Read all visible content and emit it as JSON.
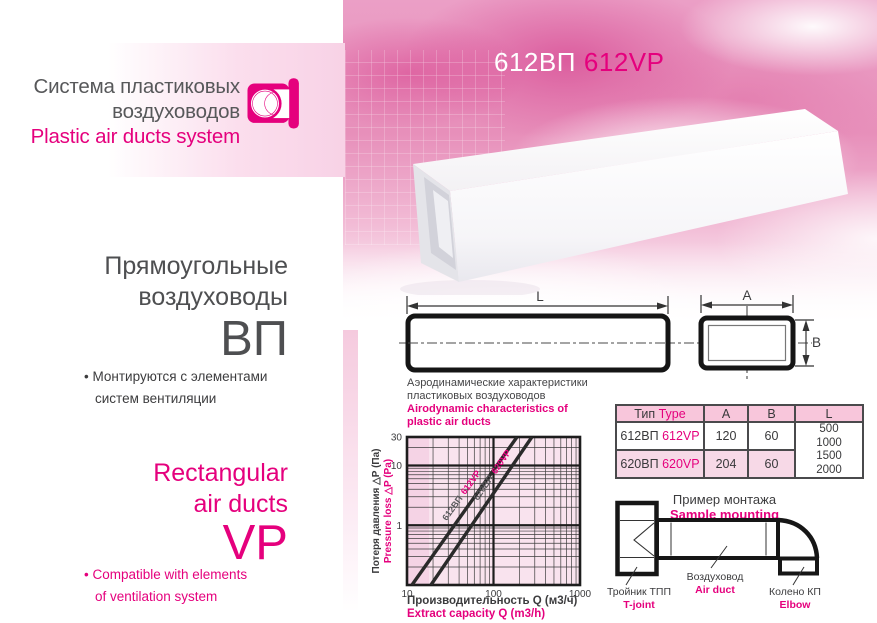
{
  "colors": {
    "accent": "#e5007d",
    "dark_text": "#4e4f51",
    "line": "#2a2a2a",
    "table_header_bg": "#f8c6db",
    "table_row2_bg": "#f7d9e7",
    "chart_bg": "#f9e3ee"
  },
  "brand": {
    "title_ru_1": "Система пластиковых",
    "title_ru_2": "воздуховодов",
    "title_en": "Plastic air ducts system"
  },
  "product_code": {
    "ru": "612ВП",
    "en": "612VP"
  },
  "intro": {
    "bullet_glyph": "•",
    "heading_ru_1": "Прямоугольные",
    "heading_ru_2": "воздуховоды",
    "code_ru": "ВП",
    "bullet_ru_1": "Монтируются с элементами",
    "bullet_ru_2": "систем вентиляции",
    "heading_en_1": "Rectangular",
    "heading_en_2": "air ducts",
    "code_en": "VP",
    "bullet_en_1": "Compatible with elements",
    "bullet_en_2": "of ventilation system"
  },
  "drawing": {
    "dim_l": "L",
    "dim_a": "A",
    "dim_b": "B"
  },
  "chart_heading": {
    "ru_1": "Аэродинамические характеристики",
    "ru_2": "пластиковых воздуховодов",
    "en_1": "Airodynamic characteristics of",
    "en_2": "plastic air ducts"
  },
  "chart_data": {
    "type": "line",
    "x_scale": "log",
    "y_scale": "log",
    "xlim": [
      10,
      1000
    ],
    "ylim": [
      0.1,
      30
    ],
    "x_tick_values": [
      10,
      100,
      1000
    ],
    "x_ticks": [
      "10",
      "100",
      "1000"
    ],
    "y_tick_values": [
      30,
      10,
      1
    ],
    "y_ticks": [
      "30",
      "10",
      "1"
    ],
    "xlabel_ru": "Производительность Q (м3/ч)",
    "xlabel_en": "Extract capacity Q (m3/h)",
    "ylabel_ru": "Потеря давления △P (Па)",
    "ylabel_en": "Pressure loss △P (Pa)",
    "grid": "log minor + major decades",
    "legend": "labels rotated along lines",
    "series": [
      {
        "label_ru": "612ВП",
        "label_en": "612VP",
        "points": [
          [
            11.4,
            0.1
          ],
          [
            187,
            30
          ]
        ],
        "label_t": 0.56
      },
      {
        "label_ru": "620ВП",
        "label_en": "620VP",
        "points": [
          [
            18.9,
            0.1
          ],
          [
            278,
            30
          ]
        ],
        "label_t": 0.7
      }
    ]
  },
  "spec_table": {
    "header": {
      "type_ru": "Тип",
      "type_en": "Type",
      "a": "A",
      "b": "B",
      "l": "L"
    },
    "rows": [
      {
        "type_ru": "612ВП",
        "type_en": "612VP",
        "a": "120",
        "b": "60"
      },
      {
        "type_ru": "620ВП",
        "type_en": "620VP",
        "a": "204",
        "b": "60"
      }
    ],
    "l_values": [
      "500",
      "1000",
      "1500",
      "2000"
    ]
  },
  "mounting": {
    "title_ru": "Пример монтажа",
    "title_en": "Sample mounting",
    "tjoint_ru": "Тройник ТПП",
    "tjoint_en": "T-joint",
    "duct_ru": "Воздуховод",
    "duct_en": "Air duct",
    "elbow_ru": "Колено КП",
    "elbow_en": "Elbow"
  }
}
